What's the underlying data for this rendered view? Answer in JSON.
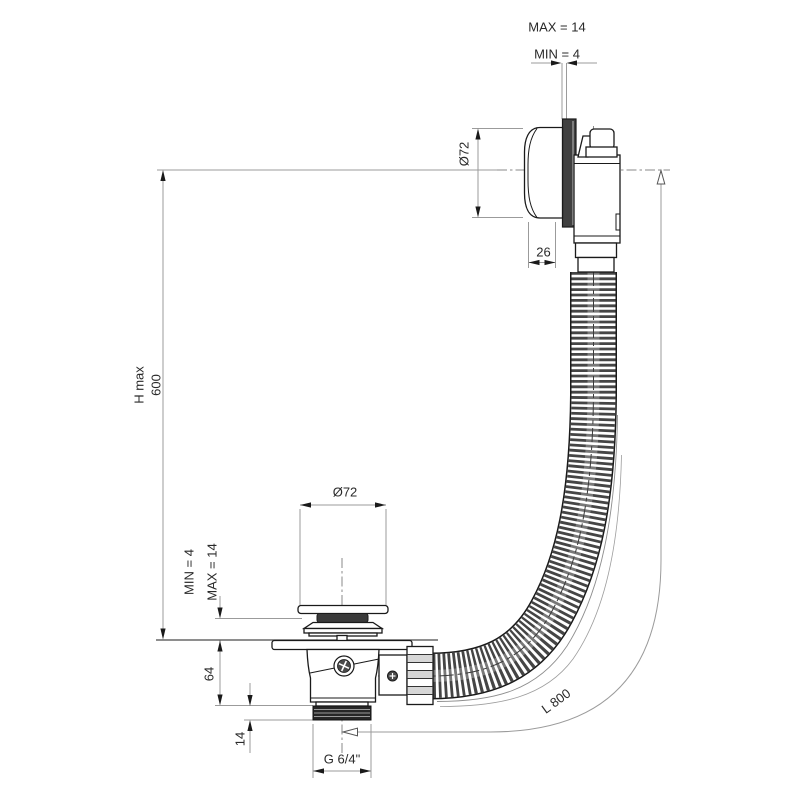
{
  "colors": {
    "background": "#ffffff",
    "ink": "#1a1a1a",
    "dimension_line": "#9b9b9b",
    "hose_rib": "#454545",
    "flange_fill": "#404040",
    "seal_fill": "#3a3a3a",
    "thread_fill": "#262626"
  },
  "annotations": {
    "overflow_gap_max": "MAX = 14",
    "overflow_gap_min": "MIN = 4",
    "overflow_diameter": "Ø72",
    "overflow_offset": "26",
    "height_label": "H max",
    "height_value": "600",
    "plug_gap_min": "MIN = 4",
    "plug_gap_max": "MAX = 14",
    "plug_diameter": "Ø72",
    "body_height": "64",
    "thread_length": "14",
    "thread_spec": "G 6/4\"",
    "hose_length": "L 800"
  }
}
